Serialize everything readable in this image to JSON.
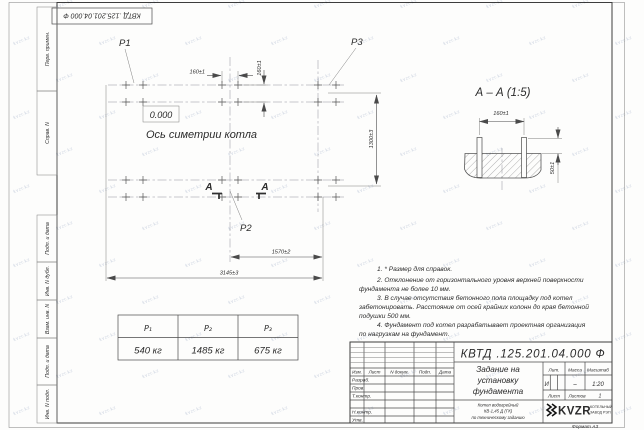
{
  "sheet": {
    "stamp_top": "КВТД .125.201.04.000 Ф",
    "format_label": "Формат А3",
    "side_labels_top": [
      "Перв. примен.",
      "Справ. N"
    ],
    "side_labels_bottom": [
      "Подп. и дата",
      "Инв. N дубл.",
      "Взам. инв. N",
      "Подп. и дата",
      "Инв. N подл."
    ],
    "watermark": {
      "text": "kvzr.kz",
      "color": "#a9b6ce"
    }
  },
  "plan": {
    "point_labels": {
      "p1": "P1",
      "p2": "P2",
      "p3": "P3"
    },
    "level_mark": "0.000",
    "axis_label": "Ось симетрии котла",
    "section_letter": "А",
    "dims": {
      "d160h": "160±1",
      "d160v": "160±1",
      "d1300": "1300±3",
      "d1570": "1570±2",
      "d3145": "3145±3"
    }
  },
  "section_view": {
    "title": "А – А (1:5)",
    "dims": {
      "d160": "160±1",
      "d50": "50±1"
    }
  },
  "notes": {
    "lines": [
      "1. * Размер для справок.",
      "2. Отклонение от горизонтального уровня верхней поверхности",
      "фундамента не более 10 мм.",
      "3. В случае отсутствия бетонного пола площадку под котел",
      "забетонировать. Расстояние от осей крайних колонн до края бетонной",
      "подушки 500 мм.",
      "4. Фундамент под котел разрабатывает проектная организация",
      "по нагрузкам на фундамент."
    ]
  },
  "load_table": {
    "headers": [
      "P₁",
      "P₂",
      "P₃"
    ],
    "values": [
      "540 кг",
      "1485 кг",
      "675 кг"
    ]
  },
  "title_block": {
    "designation": "КВТД .125.201.04.000 Ф",
    "doc_title_lines": [
      "Задание на",
      "установку",
      "фундамента"
    ],
    "product_lines": [
      "Котел водогрейный",
      "КВ-1,45 Д (ГК)",
      "по техническому заданию"
    ],
    "lit_label": "Лит.",
    "mass_label": "Масса",
    "scale_label": "Масштаб",
    "lit_value": "И",
    "mass_value": "–",
    "scale_value": "1:20",
    "sheet_label": "Лист",
    "sheets_label": "Листов",
    "sheets_value": "1",
    "header_cols": [
      "Изм.",
      "Лист",
      "N докум.",
      "Подп.",
      "Дата"
    ],
    "staff_rows": [
      "Разраб.",
      "Пров.",
      "Т.контр.",
      "Н.контр.",
      "Утв."
    ],
    "company": {
      "logo_text": "KVZR",
      "name_line1": "КОТЕЛЬНЫЙ",
      "name_line2": "ЗАВОД РЭП"
    }
  }
}
